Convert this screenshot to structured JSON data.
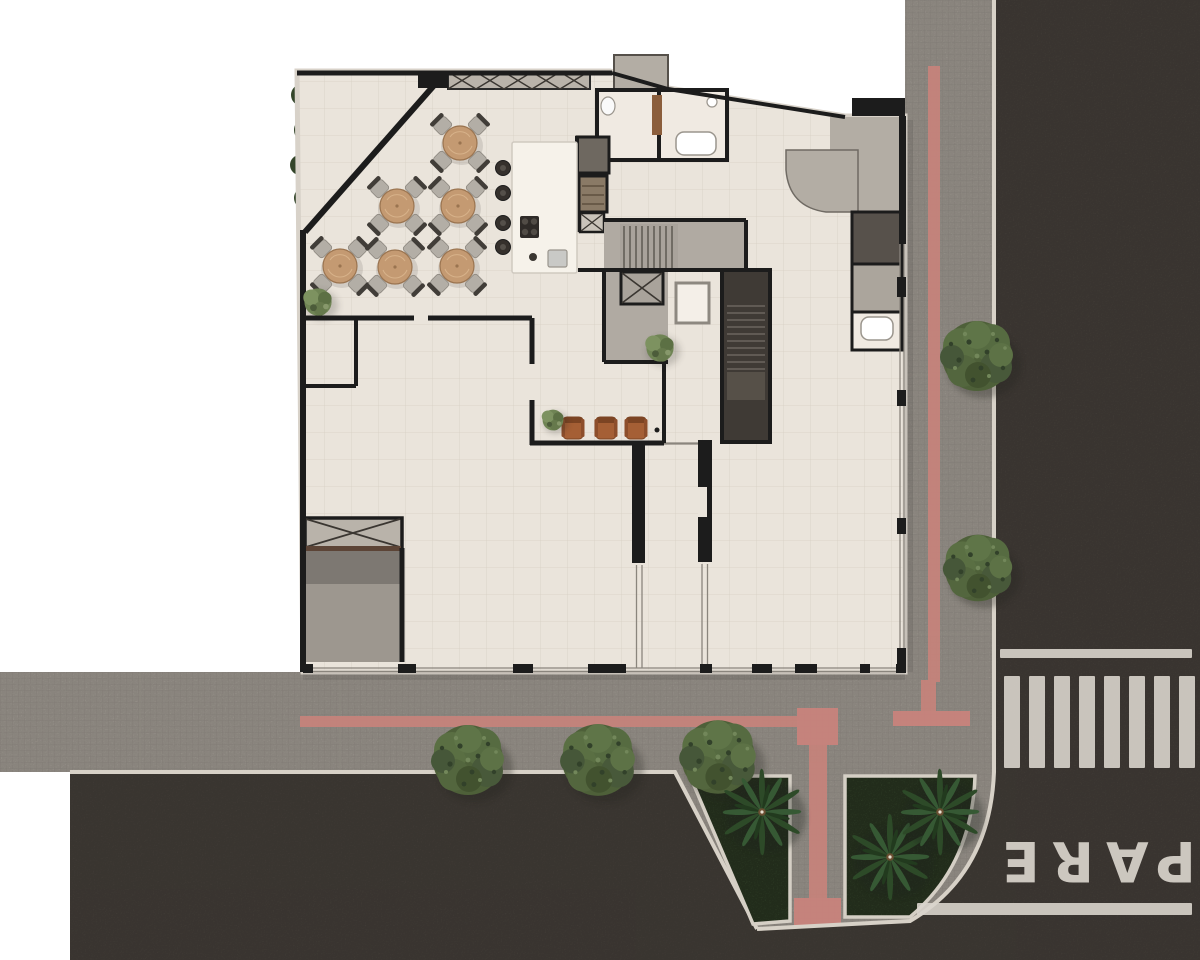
{
  "scene": {
    "description": "Top-down architectural render: corner building ground floor with cafe terrace, retail spaces, service core, sidewalks with tactile paving, street corner with crosswalk and landscaping",
    "canvas": {
      "width": 1200,
      "height": 960
    }
  },
  "palette": {
    "background": "#ffffff",
    "asphalt": "#4a443e",
    "sidewalk": "#a49e96",
    "curb": "#d7d1c7",
    "floor": "#eae4db",
    "wall": "#1c1c1c",
    "grass": "#3e5132",
    "tactile_pink": "#c5837b",
    "concrete": "#b3ada4",
    "concrete_dark": "#57514b",
    "stair": "#a9a39b",
    "stairwell_dark": "#3f3a35",
    "wood_table": "#c49a72",
    "chair_gray": "#b3aea6",
    "leather": "#a55f35",
    "marking_white": "#d9d4cc",
    "glass": "#8a857d"
  },
  "markings": {
    "stop_text": "PARE",
    "crosswalk": {
      "x_start": 1004,
      "stripe_width": 16,
      "gap": 9,
      "count": 8,
      "y": 676,
      "height": 92
    },
    "stop_line_top": {
      "x": 1000,
      "y": 649,
      "w": 192,
      "h": 9
    },
    "stop_line_bottom": {
      "x": 917,
      "y": 903,
      "w": 275,
      "h": 12
    }
  },
  "furniture": {
    "cafe_tables": [
      [
        460,
        143
      ],
      [
        397,
        206
      ],
      [
        458,
        206
      ],
      [
        340,
        266
      ],
      [
        395,
        267
      ],
      [
        457,
        266
      ]
    ],
    "bar_stools": [
      [
        503,
        168
      ],
      [
        503,
        193
      ],
      [
        503,
        223
      ],
      [
        503,
        247
      ]
    ],
    "lounge_chairs": [
      [
        573,
        428
      ],
      [
        606,
        428
      ],
      [
        636,
        428
      ]
    ]
  },
  "vegetation": {
    "street_trees": [
      [
        977,
        356,
        40
      ],
      [
        978,
        568,
        38
      ],
      [
        468,
        760,
        40
      ],
      [
        598,
        760,
        41
      ],
      [
        718,
        757,
        42
      ]
    ],
    "palm_trees": [
      [
        762,
        812
      ],
      [
        890,
        857
      ],
      [
        940,
        812
      ]
    ],
    "shrubs": [
      [
        318,
        302,
        17
      ],
      [
        660,
        348,
        17
      ],
      [
        553,
        420,
        13
      ]
    ]
  }
}
